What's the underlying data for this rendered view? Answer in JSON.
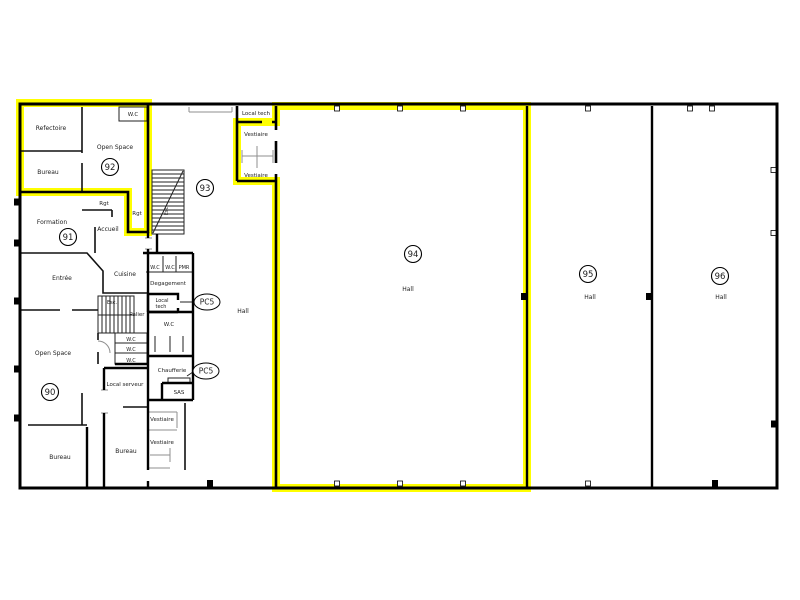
{
  "plan": {
    "background": "#ffffff",
    "wall_color": "#000000",
    "highlight_color": "#ffff00",
    "labels": [
      {
        "text": "W.C",
        "x": 133,
        "y": 116,
        "s": 5.5
      },
      {
        "text": "Refectoire",
        "x": 51,
        "y": 130,
        "s": 6
      },
      {
        "text": "Open Space",
        "x": 115,
        "y": 149,
        "s": 6
      },
      {
        "text": "Bureau",
        "x": 48,
        "y": 174,
        "s": 6
      },
      {
        "text": "Rgt",
        "x": 104,
        "y": 205,
        "s": 5.5
      },
      {
        "text": "Rgt",
        "x": 137,
        "y": 215,
        "s": 5.5
      },
      {
        "text": "Accueil",
        "x": 108,
        "y": 231,
        "s": 6
      },
      {
        "text": "Formation",
        "x": 52,
        "y": 224,
        "s": 6
      },
      {
        "text": "Esc",
        "x": 168,
        "y": 211,
        "s": 5,
        "rot": -90
      },
      {
        "text": "Entrée",
        "x": 62,
        "y": 280,
        "s": 6
      },
      {
        "text": "Cuisine",
        "x": 125,
        "y": 276,
        "s": 6
      },
      {
        "text": "Esc.",
        "x": 112,
        "y": 304,
        "s": 5
      },
      {
        "text": "Palier",
        "x": 137,
        "y": 316,
        "s": 5.5
      },
      {
        "text": "W.C",
        "x": 155,
        "y": 269,
        "s": 5
      },
      {
        "text": "W.C",
        "x": 170,
        "y": 269,
        "s": 5
      },
      {
        "text": "PMR",
        "x": 184,
        "y": 269,
        "s": 5
      },
      {
        "text": "Degagement",
        "x": 168,
        "y": 285,
        "s": 5.5
      },
      {
        "text": "Local",
        "x": 162,
        "y": 302,
        "s": 5
      },
      {
        "text": "tech",
        "x": 161,
        "y": 308,
        "s": 5
      },
      {
        "text": "W.C",
        "x": 169,
        "y": 326,
        "s": 5.5
      },
      {
        "text": "W.C",
        "x": 131,
        "y": 341,
        "s": 5
      },
      {
        "text": "W.C",
        "x": 131,
        "y": 351,
        "s": 5
      },
      {
        "text": "W.C",
        "x": 131,
        "y": 362,
        "s": 5
      },
      {
        "text": "Chaufferie",
        "x": 172,
        "y": 372,
        "s": 5.5
      },
      {
        "text": "SAS",
        "x": 179,
        "y": 394,
        "s": 5.5
      },
      {
        "text": "Local serveur",
        "x": 125,
        "y": 386,
        "s": 5.5
      },
      {
        "text": "Open Space",
        "x": 53,
        "y": 355,
        "s": 6
      },
      {
        "text": "Bureau",
        "x": 60,
        "y": 459,
        "s": 6
      },
      {
        "text": "Bureau",
        "x": 126,
        "y": 453,
        "s": 6
      },
      {
        "text": "Vestiaire",
        "x": 162,
        "y": 421,
        "s": 5.5
      },
      {
        "text": "Vestiaire",
        "x": 162,
        "y": 444,
        "s": 5.5
      },
      {
        "text": "Local tech",
        "x": 256,
        "y": 115,
        "s": 5.5
      },
      {
        "text": "Vestiaire",
        "x": 256,
        "y": 136,
        "s": 5.5
      },
      {
        "text": "Vestiaire",
        "x": 256,
        "y": 177,
        "s": 5.5
      },
      {
        "text": "Hall",
        "x": 243,
        "y": 313,
        "s": 6
      },
      {
        "text": "Hall",
        "x": 408,
        "y": 291,
        "s": 6
      },
      {
        "text": "Hall",
        "x": 590,
        "y": 299,
        "s": 6
      },
      {
        "text": "Hall",
        "x": 721,
        "y": 299,
        "s": 6
      }
    ],
    "badges": [
      {
        "num": "90",
        "x": 50,
        "y": 392
      },
      {
        "num": "91",
        "x": 68,
        "y": 237
      },
      {
        "num": "92",
        "x": 110,
        "y": 167
      },
      {
        "num": "93",
        "x": 205,
        "y": 188
      },
      {
        "num": "94",
        "x": 413,
        "y": 254
      },
      {
        "num": "95",
        "x": 588,
        "y": 274
      },
      {
        "num": "96",
        "x": 720,
        "y": 276
      }
    ],
    "tags": [
      {
        "text": "PC5",
        "x": 207,
        "y": 302
      },
      {
        "text": "PC5",
        "x": 206,
        "y": 371
      }
    ],
    "columns": {
      "top_hollow": [
        337,
        400,
        463,
        588,
        690,
        712
      ],
      "bottom_hollow": [
        337,
        400,
        463,
        588
      ],
      "bottom_filled": [
        210,
        715
      ],
      "left_filled": [
        202,
        243,
        301,
        369,
        418
      ],
      "right_hollow": [
        170,
        233
      ],
      "right_filled": [
        424
      ],
      "inner_filled": [
        {
          "x": 524,
          "y": 293
        },
        {
          "x": 649,
          "y": 293
        }
      ]
    }
  }
}
